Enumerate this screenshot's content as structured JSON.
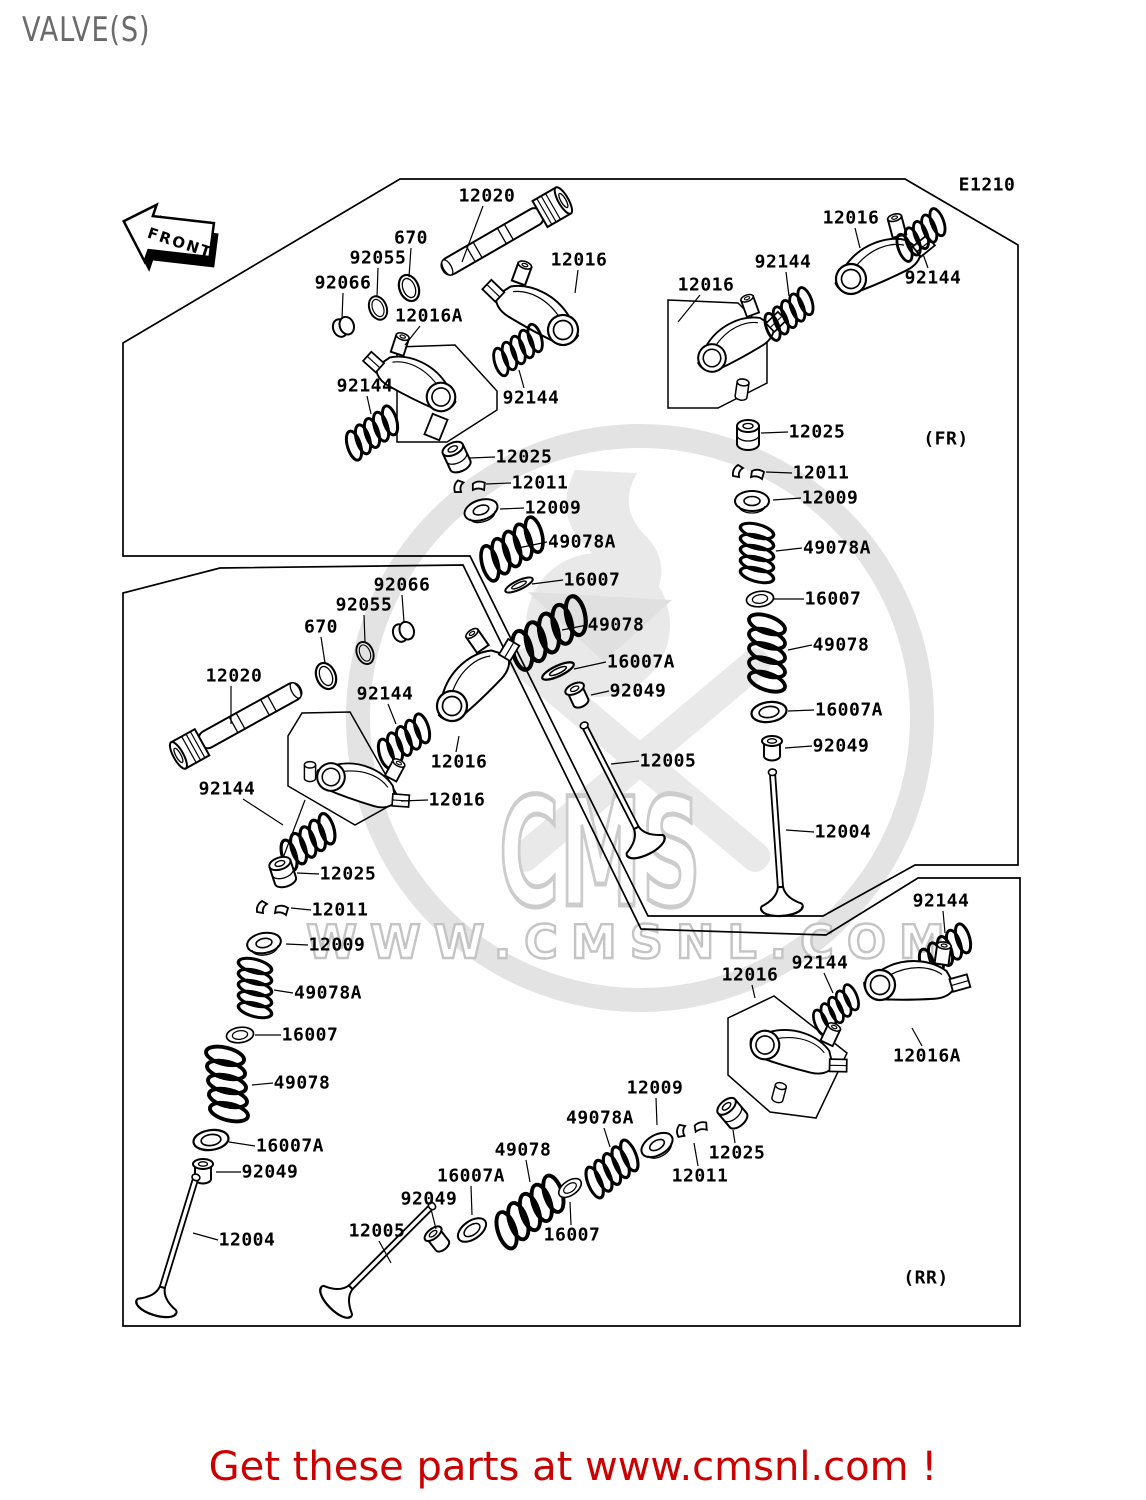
{
  "page": {
    "title": "VALVE(S)",
    "diagram_code": "E1210",
    "front_arrow": "FRONT",
    "caption": "Get these parts at www.cmsnl.com !"
  },
  "watermark": {
    "logo_text": "CMS",
    "url_text": "WWW.CMSNL.COM"
  },
  "colors": {
    "line": "#000000",
    "title_gray": "#6a6a6a",
    "caption_red": "#cc0000",
    "watermark_gray": "#e3e3e3"
  },
  "part_labels": [
    {
      "text": "12020",
      "x": 487,
      "y": 196,
      "leader": [
        483,
        206,
        462,
        262
      ]
    },
    {
      "text": "670",
      "x": 411,
      "y": 238,
      "leader": [
        411,
        248,
        409,
        277
      ]
    },
    {
      "text": "92055",
      "x": 378,
      "y": 258,
      "leader": [
        378,
        268,
        377,
        297
      ]
    },
    {
      "text": "92066",
      "x": 343,
      "y": 283,
      "leader": [
        343,
        293,
        342,
        319
      ]
    },
    {
      "text": "12016A",
      "x": 429,
      "y": 316,
      "leader": [
        420,
        326,
        405,
        345
      ]
    },
    {
      "text": "12016",
      "x": 579,
      "y": 260,
      "leader": [
        578,
        270,
        575,
        293
      ]
    },
    {
      "text": "12016",
      "x": 706,
      "y": 285,
      "leader": [
        700,
        295,
        678,
        322
      ]
    },
    {
      "text": "12016",
      "x": 851,
      "y": 218,
      "leader": [
        855,
        228,
        860,
        248
      ]
    },
    {
      "text": "92144",
      "x": 783,
      "y": 262,
      "leader": [
        786,
        272,
        789,
        296
      ]
    },
    {
      "text": "92144",
      "x": 933,
      "y": 278,
      "leader": [
        928,
        268,
        923,
        254
      ]
    },
    {
      "text": "92144",
      "x": 365,
      "y": 386,
      "leader": [
        367,
        396,
        371,
        414
      ]
    },
    {
      "text": "92144",
      "x": 531,
      "y": 398,
      "leader": [
        524,
        388,
        519,
        370
      ]
    },
    {
      "text": "12025",
      "x": 524,
      "y": 457,
      "leader": [
        495,
        457,
        470,
        458
      ]
    },
    {
      "text": "12011",
      "x": 540,
      "y": 483,
      "leader": [
        511,
        483,
        486,
        484
      ]
    },
    {
      "text": "12009",
      "x": 553,
      "y": 508,
      "leader": [
        524,
        508,
        500,
        509
      ]
    },
    {
      "text": "49078A",
      "x": 582,
      "y": 542,
      "leader": [
        547,
        542,
        518,
        548
      ]
    },
    {
      "text": "16007",
      "x": 592,
      "y": 580,
      "leader": [
        563,
        580,
        532,
        584
      ]
    },
    {
      "text": "49078",
      "x": 616,
      "y": 625,
      "leader": [
        587,
        625,
        562,
        630
      ]
    },
    {
      "text": "16007A",
      "x": 641,
      "y": 662,
      "leader": [
        606,
        662,
        574,
        669
      ]
    },
    {
      "text": "92049",
      "x": 638,
      "y": 691,
      "leader": [
        609,
        691,
        591,
        695
      ]
    },
    {
      "text": "12005",
      "x": 668,
      "y": 761,
      "leader": [
        639,
        761,
        611,
        764
      ]
    },
    {
      "text": "12025",
      "x": 817,
      "y": 432,
      "leader": [
        788,
        432,
        761,
        433
      ]
    },
    {
      "text": "12011",
      "x": 821,
      "y": 473,
      "leader": [
        792,
        473,
        766,
        472
      ]
    },
    {
      "text": "12009",
      "x": 830,
      "y": 498,
      "leader": [
        801,
        498,
        773,
        500
      ]
    },
    {
      "text": "49078A",
      "x": 837,
      "y": 548,
      "leader": [
        802,
        548,
        776,
        551
      ]
    },
    {
      "text": "16007",
      "x": 833,
      "y": 599,
      "leader": [
        804,
        599,
        774,
        599
      ]
    },
    {
      "text": "49078",
      "x": 841,
      "y": 645,
      "leader": [
        812,
        645,
        788,
        650
      ]
    },
    {
      "text": "16007A",
      "x": 849,
      "y": 710,
      "leader": [
        814,
        710,
        788,
        711
      ]
    },
    {
      "text": "92049",
      "x": 841,
      "y": 746,
      "leader": [
        812,
        746,
        785,
        748
      ]
    },
    {
      "text": "12004",
      "x": 843,
      "y": 832,
      "leader": [
        814,
        832,
        786,
        830
      ]
    },
    {
      "text": "(FR)",
      "x": 946,
      "y": 439,
      "leader": null
    },
    {
      "text": "E1210",
      "x": 987,
      "y": 185,
      "leader": null,
      "s": 16
    },
    {
      "text": "92066",
      "x": 402,
      "y": 585,
      "leader": [
        402,
        595,
        404,
        622
      ]
    },
    {
      "text": "92055",
      "x": 364,
      "y": 605,
      "leader": [
        364,
        615,
        365,
        642
      ]
    },
    {
      "text": "670",
      "x": 321,
      "y": 627,
      "leader": [
        321,
        637,
        325,
        663
      ]
    },
    {
      "text": "12020",
      "x": 234,
      "y": 676,
      "leader": [
        231,
        686,
        231,
        724
      ]
    },
    {
      "text": "92144",
      "x": 385,
      "y": 694,
      "leader": [
        388,
        704,
        396,
        724
      ]
    },
    {
      "text": "92144",
      "x": 227,
      "y": 789,
      "leader": [
        243,
        799,
        283,
        825
      ]
    },
    {
      "text": "12016",
      "x": 459,
      "y": 762,
      "leader": [
        456,
        752,
        459,
        736
      ]
    },
    {
      "text": "12016",
      "x": 457,
      "y": 800,
      "leader": [
        428,
        800,
        401,
        801
      ]
    },
    {
      "text": "12025",
      "x": 348,
      "y": 874,
      "leader": [
        319,
        874,
        297,
        873
      ]
    },
    {
      "text": "12011",
      "x": 340,
      "y": 910,
      "leader": [
        311,
        910,
        291,
        908
      ]
    },
    {
      "text": "12009",
      "x": 337,
      "y": 945,
      "leader": [
        308,
        945,
        286,
        944
      ]
    },
    {
      "text": "49078A",
      "x": 328,
      "y": 993,
      "leader": [
        293,
        993,
        274,
        990
      ]
    },
    {
      "text": "16007",
      "x": 310,
      "y": 1035,
      "leader": [
        281,
        1035,
        255,
        1035
      ]
    },
    {
      "text": "49078",
      "x": 302,
      "y": 1083,
      "leader": [
        273,
        1083,
        252,
        1085
      ]
    },
    {
      "text": "16007A",
      "x": 290,
      "y": 1146,
      "leader": [
        255,
        1146,
        229,
        1142
      ]
    },
    {
      "text": "92049",
      "x": 270,
      "y": 1172,
      "leader": [
        241,
        1172,
        216,
        1172
      ]
    },
    {
      "text": "12004",
      "x": 247,
      "y": 1240,
      "leader": [
        218,
        1240,
        193,
        1233
      ]
    },
    {
      "text": "12005",
      "x": 377,
      "y": 1231,
      "leader": [
        379,
        1241,
        391,
        1263
      ]
    },
    {
      "text": "92049",
      "x": 429,
      "y": 1199,
      "leader": [
        431,
        1209,
        436,
        1229
      ]
    },
    {
      "text": "16007A",
      "x": 471,
      "y": 1176,
      "leader": [
        471,
        1186,
        472,
        1215
      ]
    },
    {
      "text": "49078",
      "x": 523,
      "y": 1150,
      "leader": [
        526,
        1160,
        530,
        1182
      ]
    },
    {
      "text": "16007",
      "x": 572,
      "y": 1235,
      "leader": [
        571,
        1225,
        570,
        1202
      ]
    },
    {
      "text": "49078A",
      "x": 600,
      "y": 1118,
      "leader": [
        604,
        1128,
        610,
        1147
      ]
    },
    {
      "text": "12009",
      "x": 655,
      "y": 1088,
      "leader": [
        656,
        1098,
        657,
        1125
      ]
    },
    {
      "text": "12011",
      "x": 700,
      "y": 1176,
      "leader": [
        698,
        1166,
        694,
        1143
      ]
    },
    {
      "text": "12025",
      "x": 737,
      "y": 1153,
      "leader": [
        735,
        1143,
        733,
        1130
      ]
    },
    {
      "text": "92144",
      "x": 941,
      "y": 901,
      "leader": [
        943,
        911,
        945,
        933
      ]
    },
    {
      "text": "92144",
      "x": 820,
      "y": 963,
      "leader": [
        824,
        973,
        833,
        993
      ]
    },
    {
      "text": "12016",
      "x": 750,
      "y": 975,
      "leader": [
        752,
        985,
        755,
        998
      ]
    },
    {
      "text": "12016A",
      "x": 927,
      "y": 1056,
      "leader": [
        922,
        1046,
        912,
        1028
      ]
    },
    {
      "text": "(RR)",
      "x": 926,
      "y": 1278,
      "leader": null
    }
  ]
}
